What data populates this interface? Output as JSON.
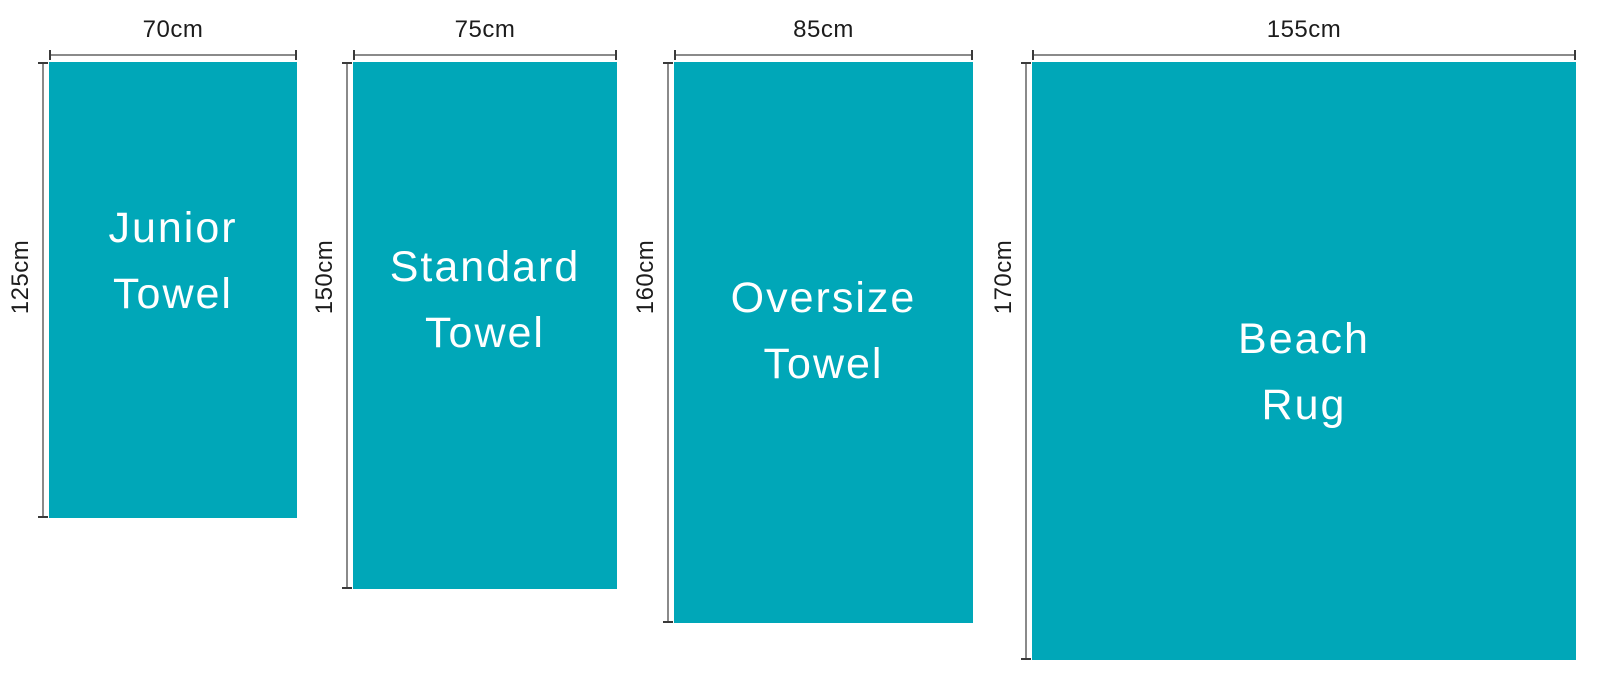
{
  "diagram": {
    "title": "towel-size-comparison",
    "unit": "cm",
    "towels": [
      {
        "name_line1": "Junior",
        "name_line2": "Towel",
        "width_label": "70cm",
        "height_label": "125cm",
        "width_cm": 70,
        "height_cm": 125
      },
      {
        "name_line1": "Standard",
        "name_line2": "Towel",
        "width_label": "75cm",
        "height_label": "150cm",
        "width_cm": 75,
        "height_cm": 150
      },
      {
        "name_line1": "Oversize",
        "name_line2": "Towel",
        "width_label": "85cm",
        "height_label": "160cm",
        "width_cm": 85,
        "height_cm": 160
      },
      {
        "name_line1": "Beach",
        "name_line2": "Rug",
        "width_label": "155cm",
        "height_label": "170cm",
        "width_cm": 155,
        "height_cm": 170
      }
    ],
    "colors": {
      "towel_fill": "#00a7b8",
      "towel_label_text": "#ffffff",
      "dimension_text": "#1c1c1c",
      "dimension_line": "#8a8a8a",
      "dimension_tick": "#3a3a3a",
      "background": "#ffffff"
    }
  }
}
